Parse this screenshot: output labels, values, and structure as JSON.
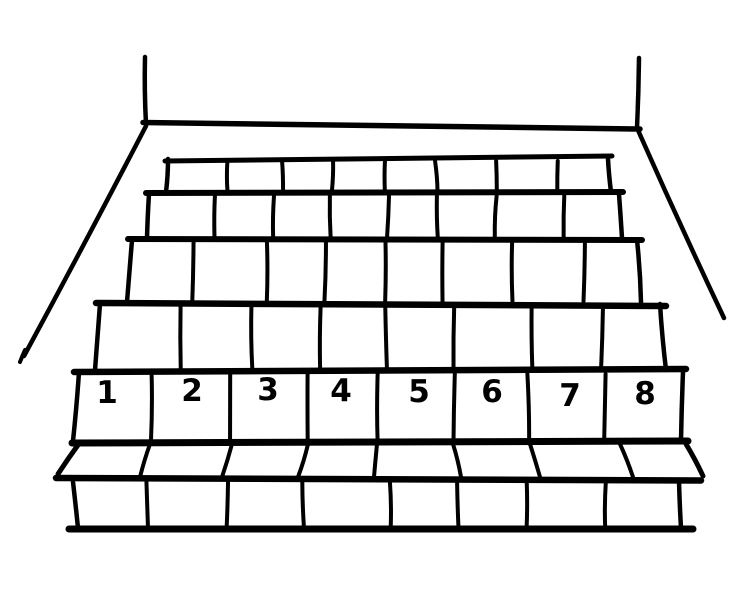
{
  "figure": {
    "kind": "hand-drawn black-and-white line illustration",
    "subject": "wide staircase seen from the front, bottom step row numbered",
    "step_count": 8,
    "block_rows": 7,
    "blocks_per_row": 8
  },
  "step_numbers": [
    "1",
    "2",
    "3",
    "4",
    "5",
    "6",
    "7",
    "8"
  ],
  "colors": {
    "ink": "#000000",
    "background": "#ffffff"
  }
}
